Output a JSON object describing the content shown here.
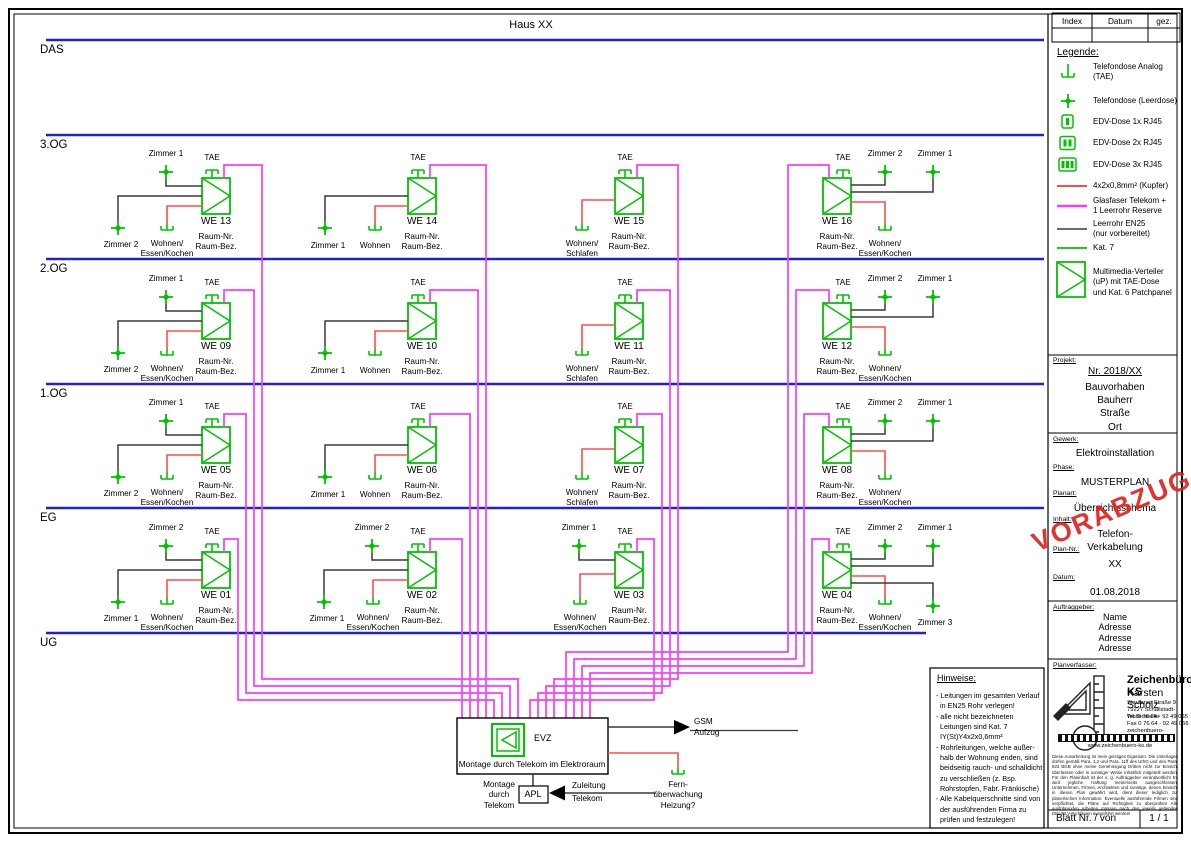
{
  "title": "Haus XX",
  "index_table": {
    "index": "Index",
    "datum": "Datum",
    "gez": "gez."
  },
  "floors": [
    {
      "label": "DAS"
    },
    {
      "label": "3.OG"
    },
    {
      "label": "2.OG"
    },
    {
      "label": "1.OG"
    },
    {
      "label": "EG"
    },
    {
      "label": "UG"
    }
  ],
  "legend": {
    "heading": "Legende:",
    "items": [
      {
        "icon": "tae-icon",
        "label": "Telefondose Analog\n(TAE)"
      },
      {
        "icon": "leerdose-star-icon",
        "label": "Telefondose (Leerdose)"
      },
      {
        "icon": "edv-dose-1x-icon",
        "label": "EDV-Dose 1x RJ45"
      },
      {
        "icon": "edv-dose-2x-icon",
        "label": "EDV-Dose 2x RJ45"
      },
      {
        "icon": "edv-dose-3x-icon",
        "label": "EDV-Dose 3x RJ45"
      },
      {
        "icon": "copper-line-swatch",
        "label": "4x2x0,8mm² (Kupfer)"
      },
      {
        "icon": "fiber-line-swatch",
        "label": "Glasfaser Telekom +\n1 Leerrohr Reserve"
      },
      {
        "icon": "conduit-line-swatch",
        "label": "Leerrohr EN25\n(nur vorbereitet)"
      },
      {
        "icon": "cat7-line-swatch",
        "label": "Kat. 7"
      },
      {
        "icon": "multimedia-verteiler-icon",
        "label": "Multimedia-Verteiler\n(uP) mit TAE-Dose\nund Kat. 6 Patchpanel"
      }
    ]
  },
  "unit_common": {
    "tae": "TAE",
    "raum_nr": "Raum-Nr.",
    "raum_bez": "Raum-Bez."
  },
  "units": [
    {
      "name": "WE 01",
      "rooms": [
        "Zimmer 2",
        "Zimmer 1",
        "Wohnen/\nEssen/Kochen"
      ]
    },
    {
      "name": "WE 02",
      "rooms": [
        "Zimmer 2",
        "Zimmer 1",
        "Wohnen/\nEssen/Kochen"
      ]
    },
    {
      "name": "WE 03",
      "rooms": [
        "Zimmer 1",
        "Wohnen/\nEssen/Kochen"
      ]
    },
    {
      "name": "WE 04",
      "rooms": [
        "Zimmer 2",
        "Zimmer 1",
        "Wohnen/\nEssen/Kochen",
        "Zimmer 3"
      ]
    },
    {
      "name": "WE 05",
      "rooms": [
        "Zimmer 1",
        "Zimmer 2",
        "Wohnen/\nEssen/Kochen"
      ]
    },
    {
      "name": "WE 06",
      "rooms": [
        "Zimmer 1",
        "Wohnen"
      ]
    },
    {
      "name": "WE 07",
      "rooms": [
        "Wohnen/\nSchlafen"
      ]
    },
    {
      "name": "WE 08",
      "rooms": [
        "Zimmer 2",
        "Zimmer 1",
        "Wohnen/\nEssen/Kochen"
      ]
    },
    {
      "name": "WE 09",
      "rooms": [
        "Zimmer 1",
        "Zimmer 2",
        "Wohnen/\nEssen/Kochen"
      ]
    },
    {
      "name": "WE 10",
      "rooms": [
        "Zimmer 1",
        "Wohnen"
      ]
    },
    {
      "name": "WE 11",
      "rooms": [
        "Wohnen/\nSchlafen"
      ]
    },
    {
      "name": "WE 12",
      "rooms": [
        "Zimmer 2",
        "Zimmer 1",
        "Wohnen/\nEssen/Kochen"
      ]
    },
    {
      "name": "WE 13",
      "rooms": [
        "Zimmer 1",
        "Zimmer 2",
        "Wohnen/\nEssen/Kochen"
      ]
    },
    {
      "name": "WE 14",
      "rooms": [
        "Zimmer 1",
        "Wohnen"
      ]
    },
    {
      "name": "WE 15",
      "rooms": [
        "Wohnen/\nSchlafen"
      ]
    },
    {
      "name": "WE 16",
      "rooms": [
        "Zimmer 2",
        "Zimmer 1",
        "Wohnen/\nEssen/Kochen"
      ]
    }
  ],
  "evz": {
    "label": "EVZ",
    "note": "Montage durch Telekom im Elektroraum",
    "apl": "APL",
    "montage_apl": "Montage\ndurch\nTelekom",
    "zuleitung": "Zuleitung\nTelekom",
    "gsm": "GSM\nAufzug",
    "heizung": "Fern-\nüberwachung\nHeizung?"
  },
  "hinweise": {
    "heading": "Hinweise:",
    "lines": [
      "- Leitungen im gesamten Verlauf",
      "  in EN25 Rohr verlegen!",
      "- alle nicht bezeichneten",
      "  Leitungen sind Kat. 7",
      "  IY(St)Y4x2x0,6mm²",
      "- Rohrleitungen, welche außer-",
      "  halb der Wohnung enden, sind",
      "  beidseitig rauch- und schalldicht",
      "  zu verschließen (z. Bsp.",
      "  Rohrstopfen, Fabr. Fränkische)",
      "- Alle Kabelquerschnitte sind von",
      "  der ausführenden Firma zu",
      "  prüfen und festzulegen!"
    ]
  },
  "titleblock": {
    "projekt_label": "Projekt:",
    "projekt_nr": "Nr. 2018/XX",
    "projekt_lines": "Bauvorhaben\nBauherr\nStraße\nOrt",
    "gewerk_label": "Gewerk:",
    "gewerk": "Elektroinstallation",
    "phase_label": "Phase:",
    "phase": "MUSTERPLAN",
    "planart_label": "Planart:",
    "planart": "Übersichtsschema",
    "inhalt_label": "Inhalt:",
    "inhalt": "Telefon-Verkabelung",
    "plannr_label": "Plan-Nr.:",
    "plannr": "XX",
    "datum_label": "Datum:",
    "datum": "01.08.2018",
    "auftraggeber_label": "Auftraggeber:",
    "auftraggeber": "Name\nAdresse\nAdresse\nAdresse",
    "planverfasser_label": "Planverfasser:",
    "firma": "Zeichenbüro KS",
    "inhaber": "Karsten Scholz",
    "strasse": "Staufener Straße 9",
    "ort": "79227 Schallstadt-Wolfenweiler",
    "tel": "Tel.  0 76 64 - 92 49 065",
    "fax": "Fax  0 76 64 - 92 49 066",
    "email": "zeichenbuero-ks@online.de",
    "web": "www.zeichenbuero-ks.de",
    "disclaimer": "Diese Ausarbeitung ist mein geistiges Eigentum. Die Unterlagen dürfen gemäß Para. 1,2 und Para. 11ff des UrhG und des Para. 823 BGB ohne meine Genehmigung Dritten nicht zur Einsicht überlassen oder in sonstiger Weise inhaltlich mitgeteilt werden. Für den Planinhalt ist der o. g. Auftraggeber verantwortlich! Es wird jegliche Haftung meinerseits ausgeschlossen! Unternehmen, Firmen, Architekten und sonstige, denen Einsicht in diesen Plan gewährt wird, dient dieser lediglich zur planerischen Information. Eventuelle ausführende Firmen sind verpflichtet, die Pläne auf Richtigkeit zu überprüfen! Alle ausführenden Arbeiten müssen nach den jeweils geltenden DIN-/ELV-Richtlinien ausgeführt werden!",
    "blatt_label": "Blatt Nr. / von",
    "blatt_value": "1 / 1"
  },
  "watermark": "VORABZUG",
  "colors": {
    "green": "#00c300",
    "magenta": "#fa3cfa",
    "red": "#ff4d4d",
    "blue": "#2121cd",
    "line_black": "#3a3a3a",
    "watermark_red": "#df231d"
  }
}
